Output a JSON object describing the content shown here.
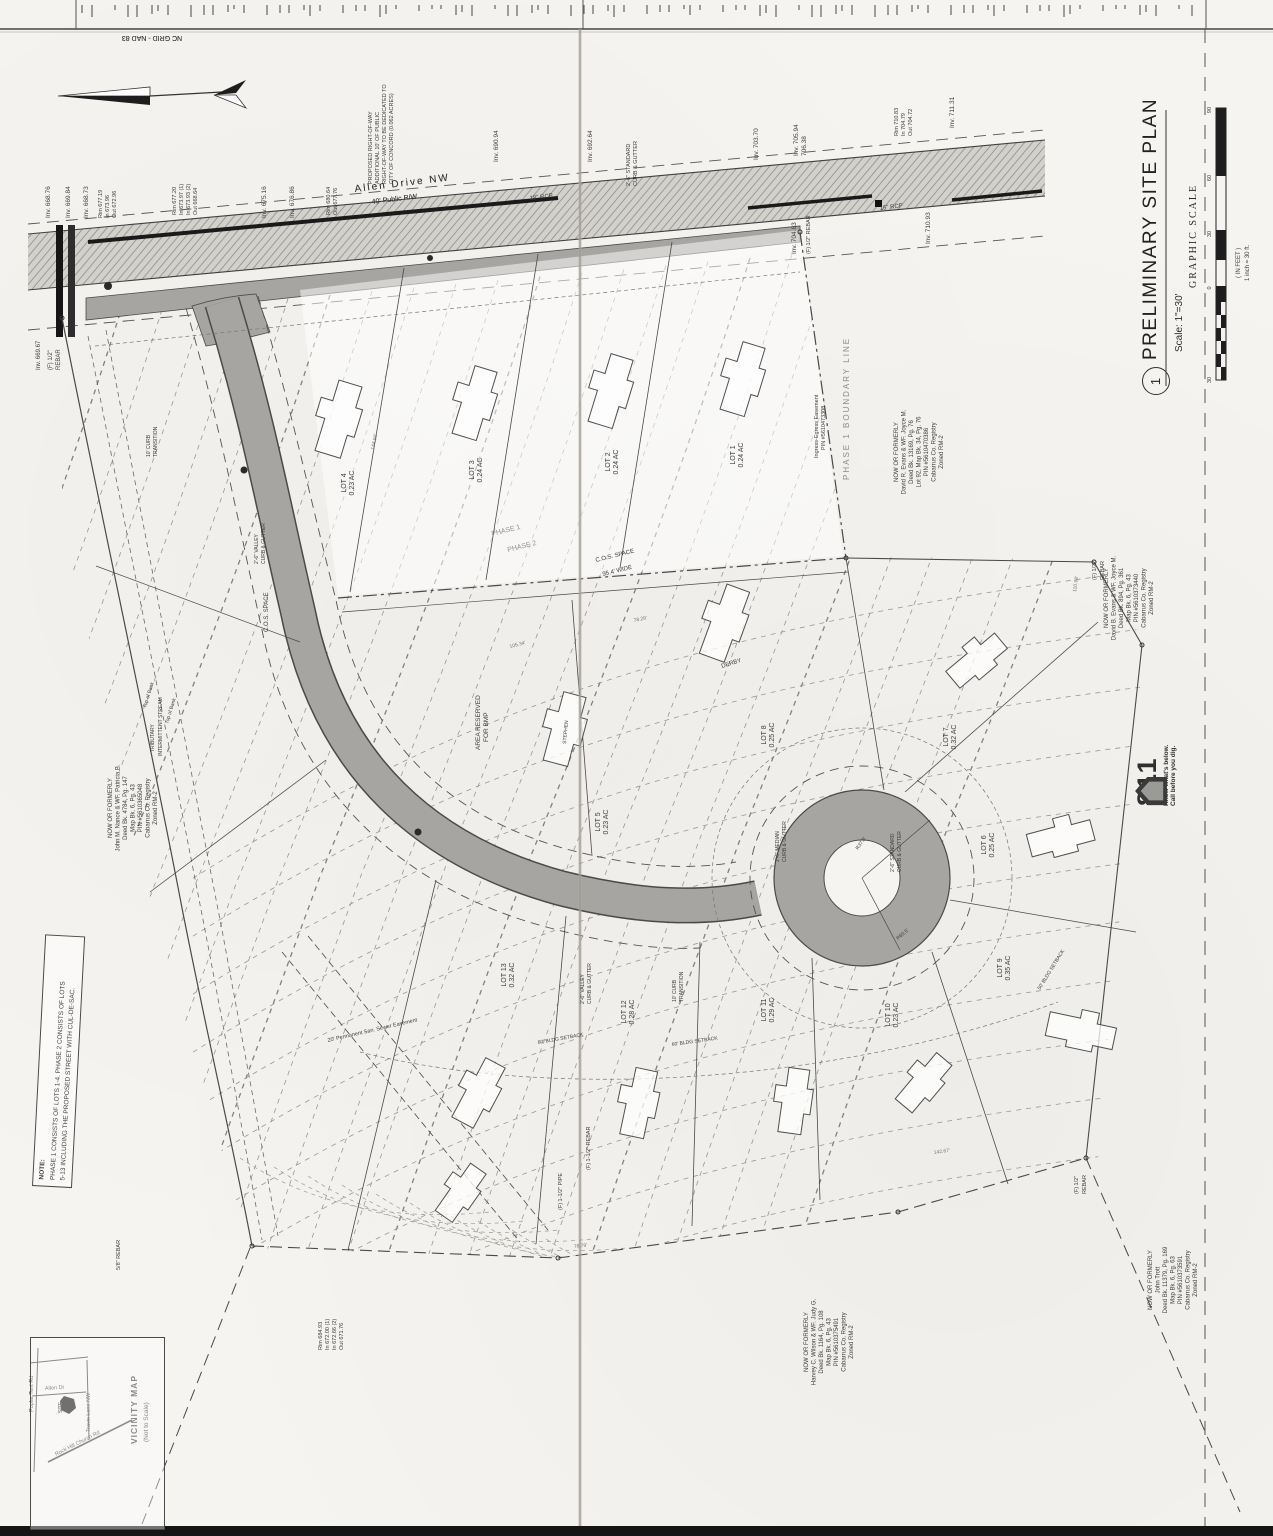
{
  "title_block": {
    "sheet_number": "1",
    "title": "PRELIMINARY SITE PLAN",
    "scale": "Scale: 1\"=30'",
    "graphic_scale": {
      "label": "GRAPHIC SCALE",
      "units": "( IN FEET )",
      "note": "1 inch = 30 ft.",
      "numbers": [
        "30",
        "0",
        "30",
        "60",
        "90"
      ]
    }
  },
  "logo_811": {
    "number": "811",
    "line1": "Know what's below.",
    "line2": "Call before you dig."
  },
  "note_box": {
    "heading": "NOTE:",
    "line1": "PHASE 1 CONSISTS OF LOTS 1-4.  PHASE 2 CONSISTS OF LOTS",
    "line2": "5-13 INCLUDING THE PROPOSED STREET WITH CUL-DE-SAC."
  },
  "vicinity_map": {
    "title": "VICINITY MAP",
    "subtitle": "(Not to Scale)",
    "site_label": "SITE",
    "roads": [
      "Poplar Tent Rd",
      "Allen Dr",
      "Travis Lane NW",
      "Rock Hill Church Rd"
    ]
  },
  "north_arrow": {
    "label": "NC GRID - NAD 83"
  },
  "road": {
    "name": "Allen Drive NW",
    "rw": "40' Public R/W"
  },
  "lots": [
    {
      "name": "LOT 1",
      "area": "0.24 AC"
    },
    {
      "name": "LOT 2",
      "area": "0.24 AC"
    },
    {
      "name": "LOT 3",
      "area": "0.24 AC"
    },
    {
      "name": "LOT 4",
      "area": "0.23 AC"
    },
    {
      "name": "LOT 5",
      "area": "0.23 AC"
    },
    {
      "name": "LOT 6",
      "area": "0.25 AC"
    },
    {
      "name": "LOT 7",
      "area": "0.32 AC"
    },
    {
      "name": "LOT 8",
      "area": "0.25 AC"
    },
    {
      "name": "LOT 9",
      "area": "0.35 AC"
    },
    {
      "name": "LOT 10",
      "area": "0.23 AC"
    },
    {
      "name": "LOT 11",
      "area": "0.29 AC"
    },
    {
      "name": "LOT 12",
      "area": "0.28 AC"
    },
    {
      "name": "LOT 13",
      "area": "0.32 AC"
    }
  ],
  "owners": [
    {
      "lines": [
        "NOW OR FORMERLY",
        "John M. Nance & WF. Patricia B.",
        "Deed Bk. 4784, Pg. 147",
        "Map Bk. 6, Pg. 43",
        "PIN #5610365048",
        "Cabarrus Co. Registry",
        "Zoned RM-2"
      ]
    },
    {
      "lines": [
        "NOW OR FORMERLY",
        "David R. Evans & WF. Joyce M.",
        "Deed Bk. 13169, Pg. 76",
        "Lot 92, Map Bk. 34, Pg. 76",
        "PIN #5610470386",
        "Cabarrus Co. Registry",
        "Zoned RM-2"
      ]
    },
    {
      "lines": [
        "NOW OR FORMERLY",
        "David B. Evans & WF. Joyce M.",
        "Deed Bk. 894, Pg. 361",
        "Map Bk. 6, Pg. 43",
        "PIN #5610373440",
        "Cabarrus Co. Registry",
        "Zoned RM-2"
      ]
    },
    {
      "lines": [
        "NOW OR FORMERLY",
        "Harvey C. Wilson & WF. Judy G.",
        "Deed Bk. 1164, Pg. 108",
        "Map Bk. 6, Pg. 43",
        "PIN #5610375491",
        "Cabarrus Co. Registry",
        "Zoned RM-2"
      ]
    },
    {
      "lines": [
        "NOW OR FORMERLY",
        "John Trott",
        "Deed Bk. 11379, Pg. 169",
        "Map Bk. 6, Pg. 63",
        "PIN #5610373591",
        "Cabarrus Co. Registry",
        "Zoned RM-2"
      ]
    }
  ],
  "map_texts": [
    {
      "t": "NC GRID - NAD 83",
      "x": 152,
      "y": 36,
      "r": 180,
      "s": 7,
      "a": "m"
    },
    {
      "t": "Allen Drive NW",
      "x": 355,
      "y": 192,
      "r": -7,
      "s": 10,
      "ls": 2
    },
    {
      "t": "40' Public R/W",
      "x": 372,
      "y": 204,
      "r": -7,
      "s": 7
    },
    {
      "t": "Inv. 668.76",
      "x": 50,
      "y": 218,
      "r": -90,
      "s": 6.5
    },
    {
      "t": "Inv. 669.84",
      "x": 70,
      "y": 218,
      "r": -90,
      "s": 6.5
    },
    {
      "t": "Inv. 668.73",
      "x": 88,
      "y": 218,
      "r": -90,
      "s": 6.5
    },
    {
      "t": "Rim 677.19",
      "x": 102,
      "y": 218,
      "r": -90,
      "s": 5.5
    },
    {
      "t": "In 673.96",
      "x": 109,
      "y": 218,
      "r": -90,
      "s": 5.5
    },
    {
      "t": "Out 672.96",
      "x": 116,
      "y": 218,
      "r": -90,
      "s": 5.5
    },
    {
      "t": "Rim 677.20",
      "x": 176,
      "y": 215,
      "r": -90,
      "s": 5.5
    },
    {
      "t": "In 673.97 (1)",
      "x": 183,
      "y": 215,
      "r": -90,
      "s": 5.5
    },
    {
      "t": "In 673.93 (2)",
      "x": 190,
      "y": 215,
      "r": -90,
      "s": 5.5
    },
    {
      "t": "Out 668.64",
      "x": 197,
      "y": 215,
      "r": -90,
      "s": 5.5
    },
    {
      "t": "Inv. 675.16",
      "x": 266,
      "y": 218,
      "r": -90,
      "s": 6.5
    },
    {
      "t": "Inv. 676.86",
      "x": 294,
      "y": 218,
      "r": -90,
      "s": 6.5
    },
    {
      "t": "Rim 680.64",
      "x": 330,
      "y": 215,
      "r": -90,
      "s": 5.5
    },
    {
      "t": "Out 677.76",
      "x": 337,
      "y": 215,
      "r": -90,
      "s": 5.5
    },
    {
      "t": "18\" RCP",
      "x": 530,
      "y": 200,
      "r": -7,
      "s": 6
    },
    {
      "t": "Inv. 690.94",
      "x": 498,
      "y": 162,
      "r": -90,
      "s": 6.5
    },
    {
      "t": "Inv. 692.64",
      "x": 592,
      "y": 162,
      "r": -90,
      "s": 6.5
    },
    {
      "t": "Inv. 703.70",
      "x": 758,
      "y": 160,
      "r": -90,
      "s": 6.5
    },
    {
      "t": "Inv. 705.94",
      "x": 798,
      "y": 156,
      "r": -90,
      "s": 6.5
    },
    {
      "t": "706.38",
      "x": 806,
      "y": 156,
      "r": -90,
      "s": 6.5
    },
    {
      "t": "Rim 710.83",
      "x": 898,
      "y": 136,
      "r": -90,
      "s": 5.5
    },
    {
      "t": "In 704.79",
      "x": 905,
      "y": 136,
      "r": -90,
      "s": 5.5
    },
    {
      "t": "Out 704.72",
      "x": 912,
      "y": 136,
      "r": -90,
      "s": 5.5
    },
    {
      "t": "Inv. 711.31",
      "x": 954,
      "y": 128,
      "r": -90,
      "s": 6.5
    },
    {
      "t": "15\" RCP",
      "x": 880,
      "y": 210,
      "r": -7,
      "s": 6
    },
    {
      "t": "Inv. 710.93",
      "x": 930,
      "y": 244,
      "r": -90,
      "s": 6.5
    },
    {
      "t": "Inv. 704.63",
      "x": 796,
      "y": 254,
      "r": -90,
      "s": 6.5
    },
    {
      "t": "(F) 1/2\" REBAR",
      "x": 810,
      "y": 254,
      "r": -90,
      "s": 5.5
    },
    {
      "t": "Inv. 669.67",
      "x": 40,
      "y": 370,
      "r": -90,
      "s": 6
    },
    {
      "t": "(F) 1/2\"",
      "x": 52,
      "y": 370,
      "r": -90,
      "s": 6
    },
    {
      "t": "REBAR",
      "x": 60,
      "y": 370,
      "r": -90,
      "s": 6
    },
    {
      "t": "PROPOSED RIGHT-OF-WAY",
      "x": 372,
      "y": 184,
      "r": -90,
      "s": 5.5
    },
    {
      "t": "ADDITIONAL 10' OF PUBLIC",
      "x": 379,
      "y": 184,
      "r": -90,
      "s": 5.5
    },
    {
      "t": "RIGHT-OF-WAY TO BE DEDICATED TO",
      "x": 386,
      "y": 184,
      "r": -90,
      "s": 5.5
    },
    {
      "t": "CITY OF CONCORD (0.062 ACRES)",
      "x": 393,
      "y": 184,
      "r": -90,
      "s": 5.5
    },
    {
      "t": "2'-6\" STANDARD",
      "x": 630,
      "y": 186,
      "r": -90,
      "s": 5.5
    },
    {
      "t": "CURB & GUTTER",
      "x": 637,
      "y": 186,
      "r": -90,
      "s": 5.5
    },
    {
      "t": "PHASE 1 BOUNDARY LINE",
      "x": 849,
      "y": 480,
      "r": -90,
      "s": 8,
      "c": "#8b8b8b",
      "ls": 2
    },
    {
      "t": "Ingress-Egress Easement",
      "x": 818,
      "y": 458,
      "r": -90,
      "s": 5.5
    },
    {
      "t": "PIN #5610473308",
      "x": 825,
      "y": 450,
      "r": -90,
      "s": 5.5
    },
    {
      "t": "PHASE 1",
      "x": 492,
      "y": 536,
      "r": -14,
      "s": 7,
      "c": "#8f8f8f"
    },
    {
      "t": "PHASE 2",
      "x": 508,
      "y": 552,
      "r": -14,
      "s": 7,
      "c": "#8f8f8f"
    },
    {
      "t": "C.O.S. SPACE",
      "x": 596,
      "y": 562,
      "r": -14,
      "s": 6
    },
    {
      "t": "95.4' WIDE",
      "x": 603,
      "y": 576,
      "r": -14,
      "s": 6
    },
    {
      "t": "C.O.S. SPACE",
      "x": 268,
      "y": 632,
      "r": -90,
      "s": 6
    },
    {
      "t": "AREA RESERVED",
      "x": 480,
      "y": 750,
      "r": -90,
      "s": 6.5
    },
    {
      "t": "FOR BMP",
      "x": 488,
      "y": 742,
      "r": -90,
      "s": 6.5
    },
    {
      "t": "DERBY",
      "x": 722,
      "y": 668,
      "r": -18,
      "s": 6
    },
    {
      "t": "STEPHEN",
      "x": 566,
      "y": 744,
      "r": -85,
      "s": 5
    },
    {
      "t": "2'-6\" MEDIAN",
      "x": 779,
      "y": 862,
      "r": -90,
      "s": 5
    },
    {
      "t": "CURB & GUTTER",
      "x": 786,
      "y": 862,
      "r": -90,
      "s": 5
    },
    {
      "t": "2'-6\" STANDARD",
      "x": 894,
      "y": 872,
      "r": -90,
      "s": 5
    },
    {
      "t": "CURB & GUTTER",
      "x": 901,
      "y": 872,
      "r": -90,
      "s": 5
    },
    {
      "t": "R37.5'",
      "x": 858,
      "y": 850,
      "r": -55,
      "s": 5
    },
    {
      "t": "R60.5'",
      "x": 898,
      "y": 940,
      "r": -40,
      "s": 5
    },
    {
      "t": "2'-6\" VALLEY",
      "x": 584,
      "y": 1004,
      "r": -90,
      "s": 5
    },
    {
      "t": "CURB & GUTTER",
      "x": 591,
      "y": 1004,
      "r": -90,
      "s": 5
    },
    {
      "t": "2'-6\" VALLEY",
      "x": 258,
      "y": 564,
      "r": -90,
      "s": 5
    },
    {
      "t": "CURB & GUTTER",
      "x": 265,
      "y": 564,
      "r": -90,
      "s": 5
    },
    {
      "t": "10' CURB",
      "x": 676,
      "y": 1002,
      "r": -90,
      "s": 5
    },
    {
      "t": "TRANSITION",
      "x": 683,
      "y": 1002,
      "r": -90,
      "s": 5
    },
    {
      "t": "10' CURB",
      "x": 150,
      "y": 457,
      "r": -90,
      "s": 5
    },
    {
      "t": "TRANSITION",
      "x": 157,
      "y": 457,
      "r": -90,
      "s": 5
    },
    {
      "t": "60' BLDG SETBACK",
      "x": 538,
      "y": 1044,
      "r": -10,
      "s": 5
    },
    {
      "t": "60' BLDG SETBACK",
      "x": 672,
      "y": 1046,
      "r": -8,
      "s": 5
    },
    {
      "t": "50' BLDG SETBACK",
      "x": 1040,
      "y": 990,
      "r": -58,
      "s": 5
    },
    {
      "t": "20' Permanent San. Sewer Easement",
      "x": 328,
      "y": 1042,
      "r": -13,
      "s": 5.5
    },
    {
      "t": "Top of Bank",
      "x": 146,
      "y": 708,
      "r": -73,
      "s": 5
    },
    {
      "t": "Top of Bank",
      "x": 168,
      "y": 724,
      "r": -73,
      "s": 5
    },
    {
      "t": "TRIBUTARY",
      "x": 154,
      "y": 752,
      "r": -90,
      "s": 5
    },
    {
      "t": "INTERMITTENT STREAM",
      "x": 162,
      "y": 756,
      "r": -90,
      "s": 5
    },
    {
      "t": "144.60'",
      "x": 374,
      "y": 450,
      "r": -78,
      "s": 5,
      "c": "#777777"
    },
    {
      "t": "105.34'",
      "x": 510,
      "y": 648,
      "r": -14,
      "s": 5,
      "c": "#777777"
    },
    {
      "t": "78.29'",
      "x": 634,
      "y": 622,
      "r": -12,
      "s": 5,
      "c": "#777777"
    },
    {
      "t": "110.98'",
      "x": 1076,
      "y": 592,
      "r": -82,
      "s": 5,
      "c": "#777777"
    },
    {
      "t": "142.67'",
      "x": 934,
      "y": 1154,
      "r": -8,
      "s": 5,
      "c": "#777777"
    },
    {
      "t": "78.79'",
      "x": 574,
      "y": 1248,
      "r": -6,
      "s": 5,
      "c": "#777777"
    },
    {
      "t": "(F) 1/2\"",
      "x": 1096,
      "y": 580,
      "r": -90,
      "s": 5.5
    },
    {
      "t": "REBAR",
      "x": 1104,
      "y": 580,
      "r": -90,
      "s": 5.5
    },
    {
      "t": "(F) 1/2\"",
      "x": 1078,
      "y": 1194,
      "r": -90,
      "s": 5.5
    },
    {
      "t": "REBAR",
      "x": 1086,
      "y": 1194,
      "r": -90,
      "s": 5.5
    },
    {
      "t": "(F) 1-1/2\" PIPE",
      "x": 562,
      "y": 1210,
      "r": -90,
      "s": 5.5
    },
    {
      "t": "(F) 1-1/2\" REBAR",
      "x": 590,
      "y": 1170,
      "r": -90,
      "s": 5.5
    },
    {
      "t": "5/8\" REBAR",
      "x": 120,
      "y": 1270,
      "r": -90,
      "s": 5.5
    },
    {
      "t": "Rim 684.93",
      "x": 322,
      "y": 1350,
      "r": -90,
      "s": 5.5
    },
    {
      "t": "In 672.00 (1)",
      "x": 329,
      "y": 1350,
      "r": -90,
      "s": 5.5
    },
    {
      "t": "In 672.66 (2)",
      "x": 336,
      "y": 1350,
      "r": -90,
      "s": 5.5
    },
    {
      "t": "Out 671.76",
      "x": 343,
      "y": 1350,
      "r": -90,
      "s": 5.5
    }
  ],
  "colors": {
    "paper": "#f6f4f0",
    "ink": "#3a3a3a",
    "pavement": "#a6a5a1",
    "contour": "#979590",
    "scan_edge": "#151515"
  }
}
